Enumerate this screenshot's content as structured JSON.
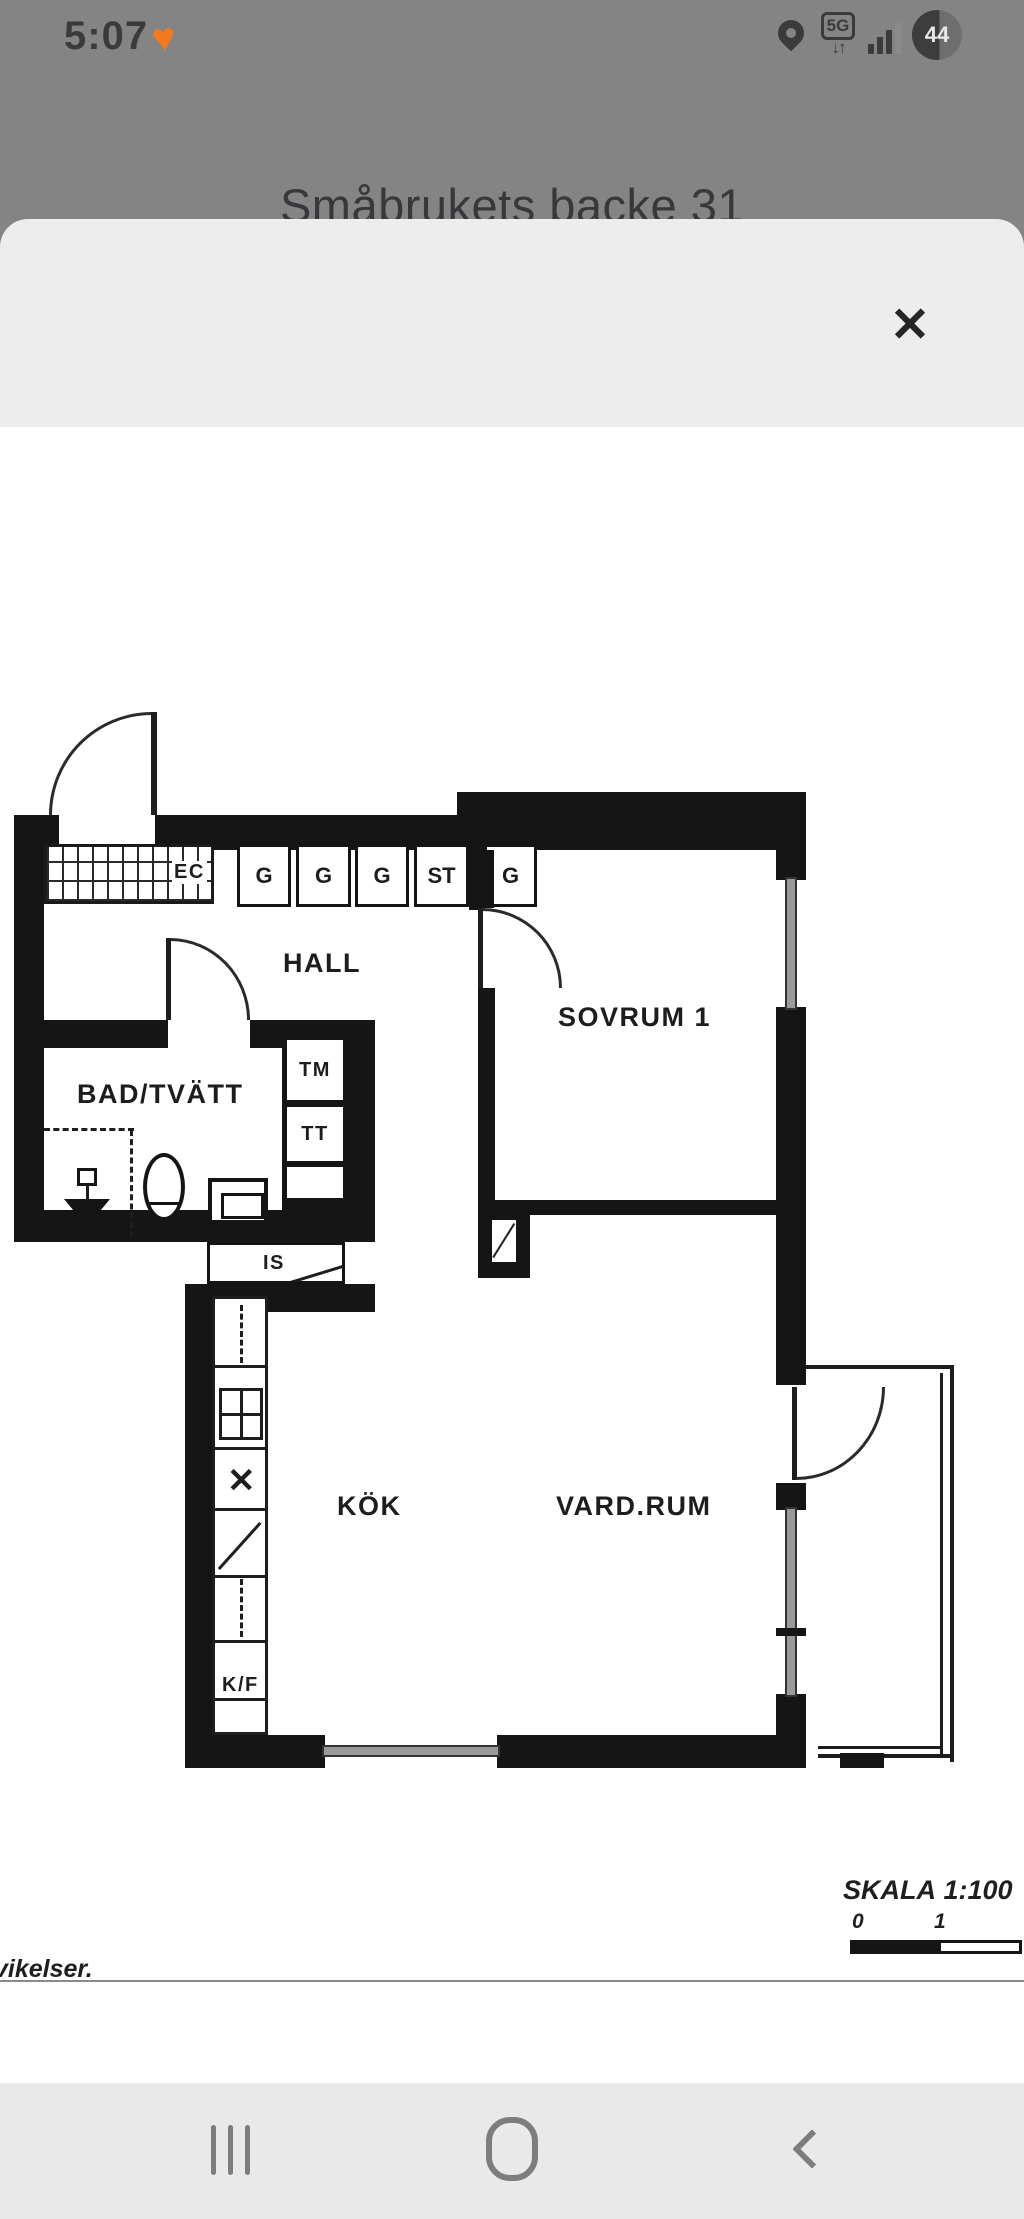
{
  "status_bar": {
    "time": "5:07",
    "network": "5G",
    "battery": "44"
  },
  "app": {
    "title": "Småbrukets backe 31"
  },
  "sheet": {
    "close_icon": "✕"
  },
  "plan": {
    "rooms": {
      "hall": "HALL",
      "sovrum": "SOVRUM 1",
      "bad": "BAD/TVÄTT",
      "kok": "KÖK",
      "vardagsrum": "VARD.RUM"
    },
    "closets": {
      "g1": "G",
      "g2": "G",
      "g3": "G",
      "st": "ST",
      "g5": "G",
      "ec": "EC"
    },
    "appliances": {
      "tm": "TM",
      "tt": "TT",
      "is": "IS",
      "kf": "K/F",
      "x": "✕"
    },
    "scale": {
      "label": "SKALA",
      "value": "1:100",
      "tick0": "0",
      "tick1": "1"
    },
    "footnote": "vikelser."
  }
}
